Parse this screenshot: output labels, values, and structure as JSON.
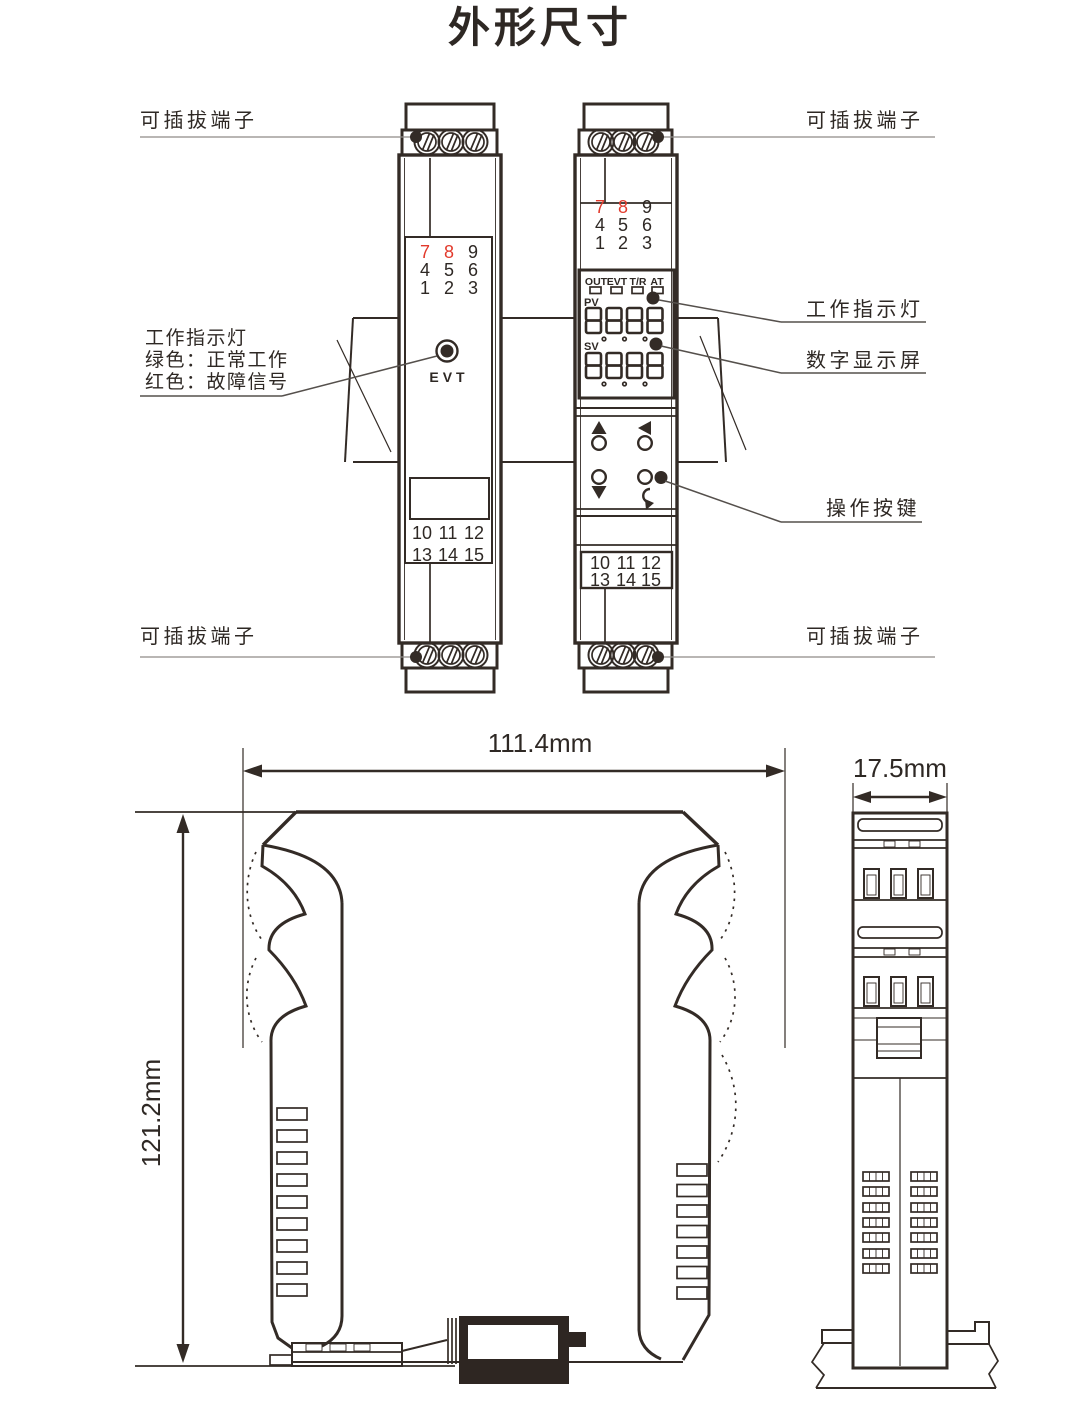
{
  "title": "外形尺寸",
  "colors": {
    "line": "#332b26",
    "red_digit": "#e23a2c",
    "leader": "#8f8b88"
  },
  "labels": {
    "pluggable_terminal": "可插拔端子",
    "work_indicator": "工作指示灯",
    "indicator_green": "绿色：正常工作",
    "indicator_red": "红色：故障信号",
    "digital_display": "数字显示屏",
    "operation_buttons": "操作按键"
  },
  "device_left": {
    "evt_label": "EVT",
    "top_terminals": [
      [
        "7",
        "8",
        "9"
      ],
      [
        "4",
        "5",
        "6"
      ],
      [
        "1",
        "2",
        "3"
      ]
    ],
    "bottom_terminals": [
      [
        "10",
        "11",
        "12"
      ],
      [
        "13",
        "14",
        "15"
      ]
    ]
  },
  "device_right": {
    "status_leds": [
      "OUT",
      "EVT",
      "T/R",
      "AT"
    ],
    "pv_label": "PV",
    "sv_label": "SV",
    "pv_value": "8888",
    "sv_value": "8888",
    "top_terminals": [
      [
        "7",
        "8",
        "9"
      ],
      [
        "4",
        "5",
        "6"
      ],
      [
        "1",
        "2",
        "3"
      ]
    ],
    "bottom_terminals": [
      [
        "10",
        "11",
        "12"
      ],
      [
        "13",
        "14",
        "15"
      ]
    ]
  },
  "dimensions": {
    "width": "111.4mm",
    "height": "121.2mm",
    "depth": "17.5mm"
  }
}
